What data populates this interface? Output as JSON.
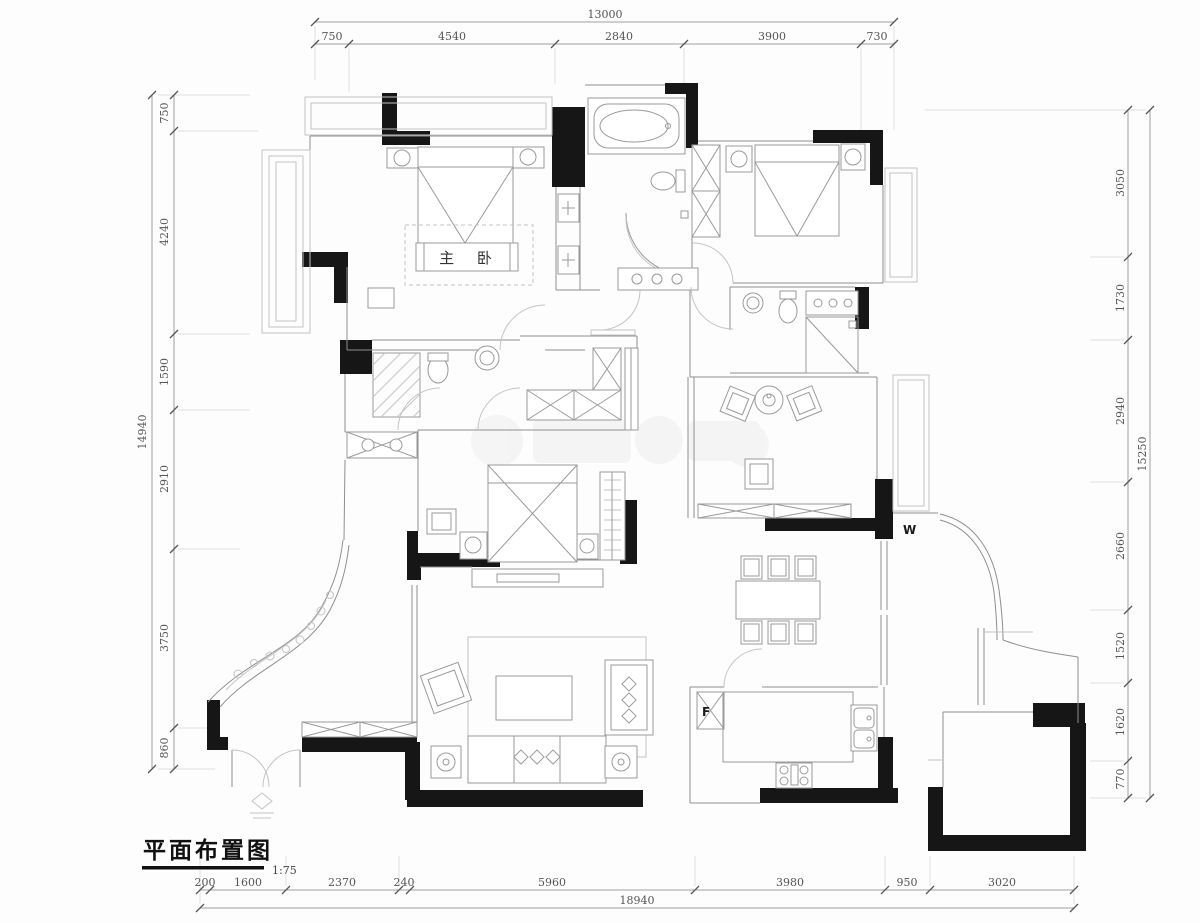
{
  "title": {
    "text": "平面布置图",
    "scale": "1:75"
  },
  "room_labels": {
    "master_bedroom": "主 卧"
  },
  "appliance_labels": {
    "washer": "W",
    "fridge": "F"
  },
  "dimensions": {
    "top": {
      "total": "13000",
      "segments": [
        "750",
        "4540",
        "2840",
        "3900",
        "730"
      ]
    },
    "left": {
      "total": "14940",
      "segments": [
        "750",
        "4240",
        "1590",
        "2910",
        "3750",
        "860"
      ]
    },
    "right": {
      "total": "15250",
      "segments": [
        "3050",
        "1730",
        "2940",
        "2660",
        "1520",
        "1620",
        "770"
      ]
    },
    "bottom": {
      "total": "18940",
      "segments": [
        "200",
        "1600",
        "2370",
        "240",
        "5960",
        "3980",
        "950",
        "3020"
      ]
    }
  },
  "colors": {
    "wall": "#161616",
    "line": "#8f8f8f",
    "dim_text": "#555555",
    "background": "#fdfdfd"
  }
}
